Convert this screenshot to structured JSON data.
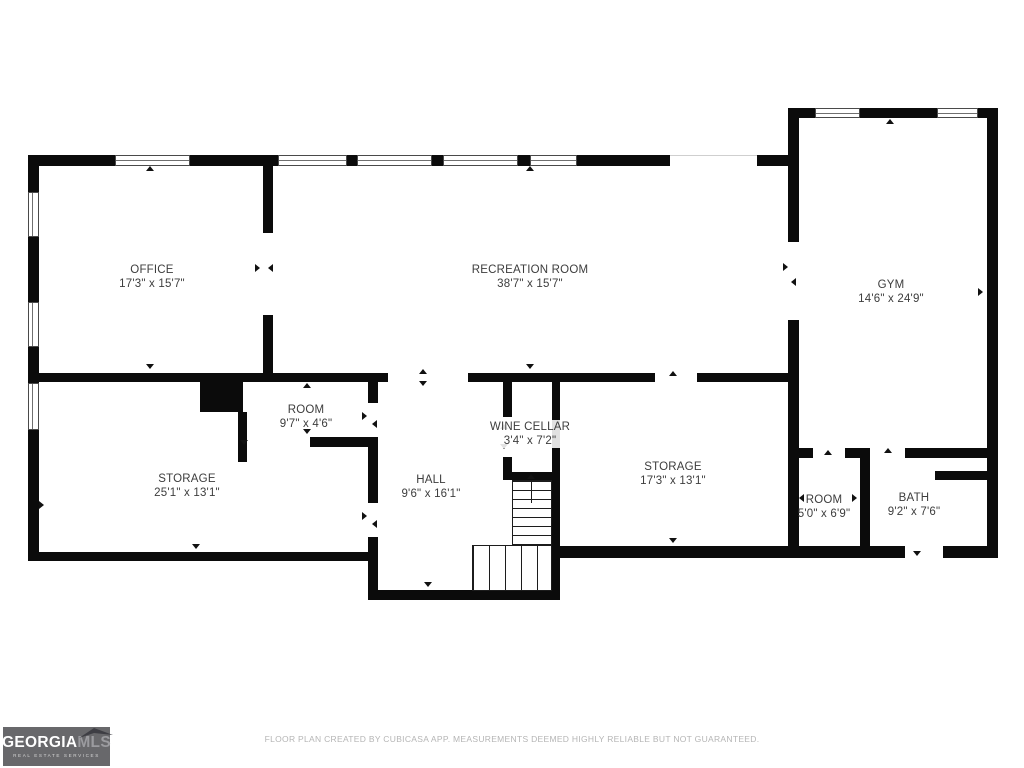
{
  "floor_plan": {
    "wall_color": "#0b0b0b",
    "rooms": [
      {
        "id": "office",
        "name": "OFFICE",
        "dimensions": "17'3\" x 15'7\""
      },
      {
        "id": "recreation-room",
        "name": "RECREATION ROOM",
        "dimensions": "38'7\" x 15'7\""
      },
      {
        "id": "gym",
        "name": "GYM",
        "dimensions": "14'6\" x 24'9\""
      },
      {
        "id": "room-upper",
        "name": "ROOM",
        "dimensions": "9'7\" x 4'6\""
      },
      {
        "id": "storage-left",
        "name": "STORAGE",
        "dimensions": "25'1\" x 13'1\""
      },
      {
        "id": "hall",
        "name": "HALL",
        "dimensions": "9'6\" x 16'1\""
      },
      {
        "id": "wine-cellar",
        "name": "WINE CELLAR",
        "dimensions": "3'4\" x 7'2\""
      },
      {
        "id": "storage-right",
        "name": "STORAGE",
        "dimensions": "17'3\" x 13'1\""
      },
      {
        "id": "room-lower",
        "name": "ROOM",
        "dimensions": "5'0\" x 6'9\""
      },
      {
        "id": "bath",
        "name": "BATH",
        "dimensions": "9'2\" x 7'6\""
      }
    ]
  },
  "logo": {
    "brand_primary": "GEORGIA",
    "brand_secondary": "MLS",
    "tagline": "REAL ESTATE SERVICES",
    "bg_color": "#68686b"
  },
  "footer": {
    "disclaimer": "FLOOR PLAN CREATED BY CUBICASA APP. MEASUREMENTS DEEMED HIGHLY RELIABLE BUT NOT GUARANTEED."
  }
}
